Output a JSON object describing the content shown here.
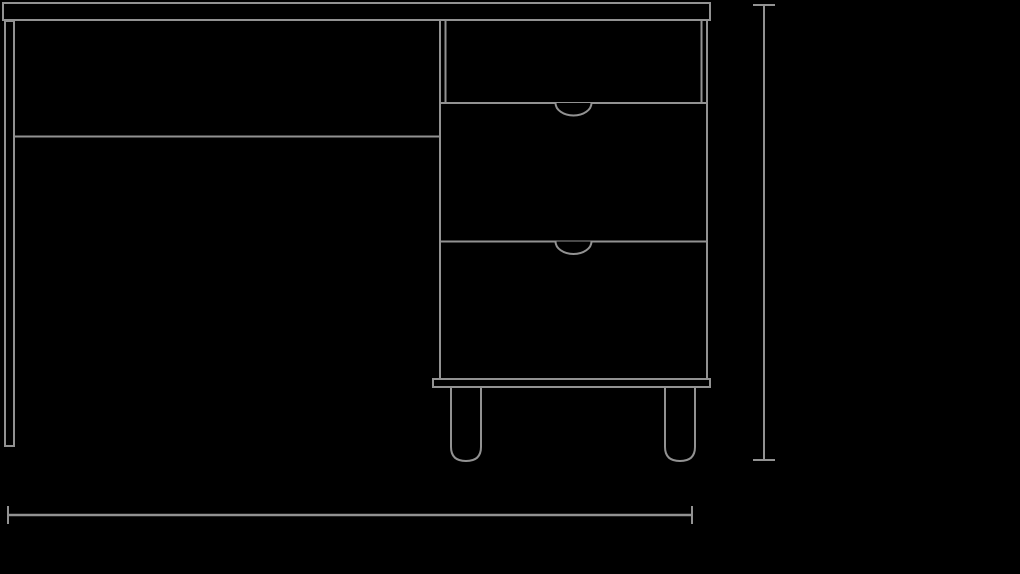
{
  "meta": {
    "title": "Desk front elevation — technical line drawing",
    "drawing_type": "furniture line drawing",
    "view": "front elevation"
  },
  "colors": {
    "background": "#000000",
    "line": "#929292"
  },
  "drawing": {
    "parts": {
      "desktop": "desk top slab",
      "left_leg": "left panel leg",
      "apron": "back apron rail",
      "cabinet": "drawer pedestal",
      "open_shelf": "open compartment",
      "drawers": "two drawer fronts",
      "drawer_count": 2,
      "drawer_pattern": "art-deco leaf relief",
      "pull_notches": "semicircular finger pulls",
      "plinth": "pedestal base rail",
      "feet": "two rounded feet",
      "feet_count": 2
    },
    "annotations": {
      "height_dimension": "vertical extent line with end ticks, right side",
      "width_dimension": "horizontal extent line with end ticks, bottom"
    }
  }
}
